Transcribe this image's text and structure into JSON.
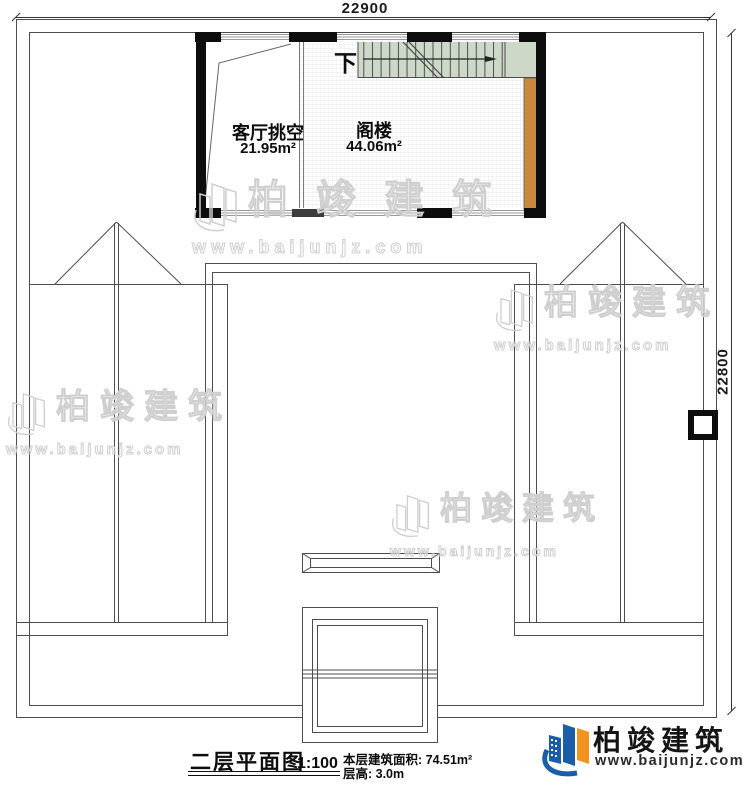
{
  "dimensions": {
    "top": "22900",
    "right": "22800"
  },
  "rooms": {
    "living_void": {
      "name": "客厅挑空",
      "area": "21.95m²"
    },
    "attic": {
      "name": "阁楼",
      "area": "44.06m²"
    }
  },
  "stairs": {
    "down_label": "下"
  },
  "watermarks": {
    "brand": "柏竣建筑",
    "site": "www.baijunjz.com"
  },
  "title_block": {
    "title": "二层平面图",
    "scale": "1:100",
    "area_text": "本层建筑面积: 74.51m²",
    "height_text": "层高: 3.0m"
  },
  "logo": {
    "brand": "柏竣建筑",
    "site": "www.baijunjz.com"
  },
  "colors": {
    "stair_green": "#cdd8c8",
    "wood_brown": "#c8893f",
    "wall_black": "#0d0d0d",
    "line_gray": "#4d4d4d",
    "logo_blue": "#1a5da8",
    "logo_orange": "#f0931f",
    "watermark_gray": "#cfcfcf"
  }
}
